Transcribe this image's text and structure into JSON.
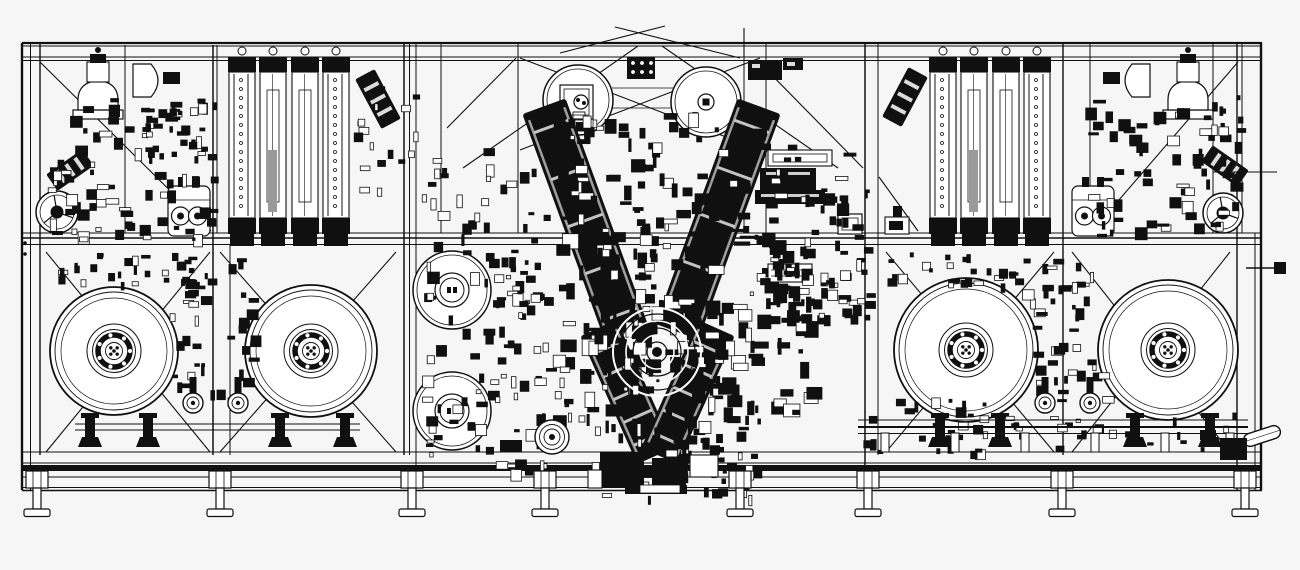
{
  "palette": {
    "ink": "#101010",
    "bg": "#f6f6f6",
    "paper": "#ffffff",
    "gray": "#9a9a9a"
  },
  "canvas": {
    "w": 1300,
    "h": 570
  },
  "seed": 11,
  "frame": {
    "rails_h": [
      [
        22,
        43,
        1262,
        2.2
      ],
      [
        22,
        46,
        1262,
        0.9
      ],
      [
        22,
        57,
        1262,
        0.9
      ],
      [
        22,
        60.5,
        1262,
        0.9
      ],
      [
        22,
        233,
        1262,
        0.9
      ],
      [
        22,
        238,
        1262,
        1.5
      ],
      [
        22,
        244.5,
        1262,
        0.9
      ],
      [
        22,
        452,
        1262,
        0.9
      ],
      [
        22,
        463,
        1262,
        0.9
      ],
      [
        22,
        477,
        1262,
        0.9
      ],
      [
        22,
        487.5,
        1262,
        0.9
      ],
      [
        22,
        490.5,
        1262,
        1.4
      ]
    ],
    "bed_band": [
      22,
      465,
      1240,
      6
    ],
    "cols": [
      [
        22,
        43,
        490,
        2.4
      ],
      [
        30.5,
        43,
        490,
        1
      ],
      [
        40,
        43,
        455,
        1.4
      ],
      [
        125,
        45,
        233,
        1
      ],
      [
        213,
        45,
        455,
        1.5
      ],
      [
        217,
        45,
        233,
        1
      ],
      [
        230,
        245,
        455,
        1
      ],
      [
        404,
        43,
        455,
        1.5
      ],
      [
        409.5,
        43,
        455,
        1
      ],
      [
        416,
        43,
        490,
        1
      ],
      [
        441,
        43,
        233,
        1
      ],
      [
        518,
        43,
        233,
        1
      ],
      [
        641,
        340,
        455,
        1
      ],
      [
        744,
        43,
        233,
        1
      ],
      [
        766,
        43,
        233,
        1
      ],
      [
        865,
        43,
        490,
        1.5
      ],
      [
        878,
        43,
        455,
        1
      ],
      [
        1063,
        43,
        455,
        1.4
      ],
      [
        1090,
        43,
        233,
        1
      ],
      [
        1213,
        43,
        233,
        1
      ],
      [
        1237,
        43,
        490,
        1.4
      ],
      [
        1242,
        43,
        233,
        1
      ],
      [
        1255,
        233,
        490,
        1
      ],
      [
        1261,
        43,
        490,
        2.4
      ]
    ],
    "braces": [
      [
        40,
        62,
        211,
        231
      ],
      [
        516,
        58,
        447,
        128
      ],
      [
        757,
        60,
        863,
        168
      ],
      [
        879,
        177,
        918,
        231
      ],
      [
        1238,
        62,
        1093,
        230
      ],
      [
        638,
        46,
        463,
        168
      ],
      [
        662,
        46,
        838,
        168
      ],
      [
        520,
        150,
        760,
        58
      ],
      [
        520,
        58,
        760,
        150
      ]
    ],
    "roof": [
      [
        560,
        53,
        665,
        26
      ],
      [
        615,
        27,
        740,
        58
      ],
      [
        744,
        28,
        744,
        57
      ]
    ],
    "x_braces": [
      [
        46,
        252,
        210,
        452
      ],
      [
        220,
        252,
        396,
        452
      ],
      [
        886,
        252,
        1054,
        452
      ],
      [
        1072,
        252,
        1230,
        452
      ]
    ],
    "grid_lines": [
      [
        612,
        88,
        700,
        88
      ],
      [
        612,
        108,
        700,
        108
      ]
    ]
  },
  "components": {
    "reels": [
      {
        "cx": 114,
        "cy": 351,
        "r": 64
      },
      {
        "cx": 311,
        "cy": 351,
        "r": 66
      },
      {
        "cx": 966,
        "cy": 350,
        "r": 72
      },
      {
        "cx": 1168,
        "cy": 350,
        "r": 70
      }
    ],
    "stands": [
      90,
      148,
      280,
      345,
      940,
      1000,
      1135,
      1210
    ],
    "stands_bars": [
      [
        75,
        424,
        360,
        424
      ],
      [
        75,
        430,
        360,
        430
      ]
    ],
    "rollers_medium": [
      {
        "cx": 452,
        "cy": 290,
        "r": 39
      },
      {
        "cx": 452,
        "cy": 411,
        "r": 39
      }
    ],
    "roller_top_left": {
      "cx": 578,
      "cy": 100,
      "r": 35
    },
    "roller_top_right": {
      "cx": 706,
      "cy": 102,
      "r": 35
    },
    "turret": {
      "cx": 657,
      "cy": 352
    },
    "capstan": {
      "cx": 552,
      "cy": 437
    },
    "dancers": [
      193,
      238,
      1045,
      1090
    ],
    "edge_rollers": [
      {
        "cx": 57,
        "cy": 212,
        "r": 21
      },
      {
        "cx": 1223,
        "cy": 213,
        "r": 20
      }
    ],
    "capsules": [
      189,
      1093
    ],
    "angled": [
      [
        70,
        170,
        44,
        20,
        -35
      ],
      [
        378,
        99,
        56,
        22,
        62
      ],
      [
        905,
        97,
        56,
        22,
        -62
      ],
      [
        1225,
        166,
        44,
        20,
        35
      ]
    ],
    "arms": [
      [
        585,
        219,
        46,
        240,
        -20
      ],
      [
        718,
        219,
        46,
        240,
        20
      ],
      [
        627,
        392,
        40,
        140,
        -24
      ],
      [
        688,
        392,
        40,
        140,
        24
      ]
    ],
    "stacks": [
      228,
      929
    ],
    "domes": [
      {
        "bell": 98,
        "dflat": 133,
        "dir": 1
      },
      {
        "bell": 1188,
        "dflat": 1150,
        "dir": -1
      }
    ],
    "hole_box": [
      627,
      57,
      28,
      22
    ],
    "solid_boxes": [
      [
        748,
        60,
        34,
        20
      ],
      [
        783,
        58,
        20,
        12
      ]
    ],
    "misc_boxes": [
      [
        768,
        150,
        64,
        16,
        0
      ],
      [
        760,
        168,
        56,
        22,
        1
      ],
      [
        755,
        190,
        70,
        14,
        1
      ]
    ],
    "label_box": [
      768,
      264,
      44,
      18
    ],
    "small_box": [
      838,
      214,
      24,
      20
    ],
    "valve": [
      886,
      206
    ],
    "conveyor": {
      "rails": [
        [
          858,
          420,
          1248,
          1
        ],
        [
          858,
          427,
          1248,
          2
        ],
        [
          858,
          433.5,
          1248,
          1
        ]
      ],
      "stand_xs": [
        885,
        955,
        1025,
        1095,
        1165,
        1230
      ],
      "capsule": [
        1262,
        436,
        -18
      ],
      "block": [
        1220,
        438,
        27,
        22
      ]
    },
    "feet": [
      37,
      220,
      412,
      545,
      740,
      868,
      1062,
      1245
    ],
    "bottom_blocks": [
      [
        600,
        452,
        44,
        36,
        1
      ],
      [
        652,
        458,
        34,
        28,
        1
      ],
      [
        690,
        455,
        28,
        22,
        0
      ],
      [
        625,
        485,
        62,
        9,
        1
      ],
      [
        588,
        470,
        14,
        18,
        0
      ],
      [
        500,
        440,
        22,
        12,
        1
      ]
    ],
    "stub_right_pin": [
      1246,
      268,
      1284,
      268
    ],
    "stub_right_square": [
      1274,
      262,
      12,
      12
    ],
    "stub_right_line": [
      1213,
      172,
      1277,
      172
    ],
    "stub_left_dots": [
      [
        25,
        243
      ],
      [
        25,
        254
      ]
    ]
  },
  "clusters": [
    [
      548,
      112,
      225,
      125,
      95,
      15
    ],
    [
      552,
      232,
      255,
      185,
      170,
      17
    ],
    [
      600,
      300,
      120,
      90,
      40,
      14
    ],
    [
      588,
      412,
      175,
      62,
      55,
      13
    ],
    [
      420,
      148,
      125,
      165,
      48,
      13
    ],
    [
      760,
      140,
      110,
      180,
      55,
      13
    ],
    [
      48,
      95,
      165,
      145,
      78,
      13
    ],
    [
      140,
      97,
      62,
      58,
      26,
      10
    ],
    [
      58,
      252,
      135,
      30,
      24,
      10
    ],
    [
      877,
      252,
      140,
      32,
      26,
      10
    ],
    [
      1085,
      95,
      155,
      140,
      72,
      13
    ],
    [
      762,
      252,
      105,
      68,
      36,
      12
    ],
    [
      494,
      255,
      52,
      215,
      42,
      12
    ],
    [
      420,
      315,
      80,
      140,
      32,
      12
    ],
    [
      170,
      258,
      82,
      142,
      46,
      12
    ],
    [
      1022,
      258,
      82,
      142,
      46,
      12
    ],
    [
      858,
      396,
      130,
      56,
      30,
      11
    ],
    [
      995,
      406,
      245,
      42,
      24,
      10
    ],
    [
      598,
      450,
      155,
      46,
      28,
      11
    ],
    [
      352,
      85,
      62,
      105,
      18,
      10
    ]
  ]
}
